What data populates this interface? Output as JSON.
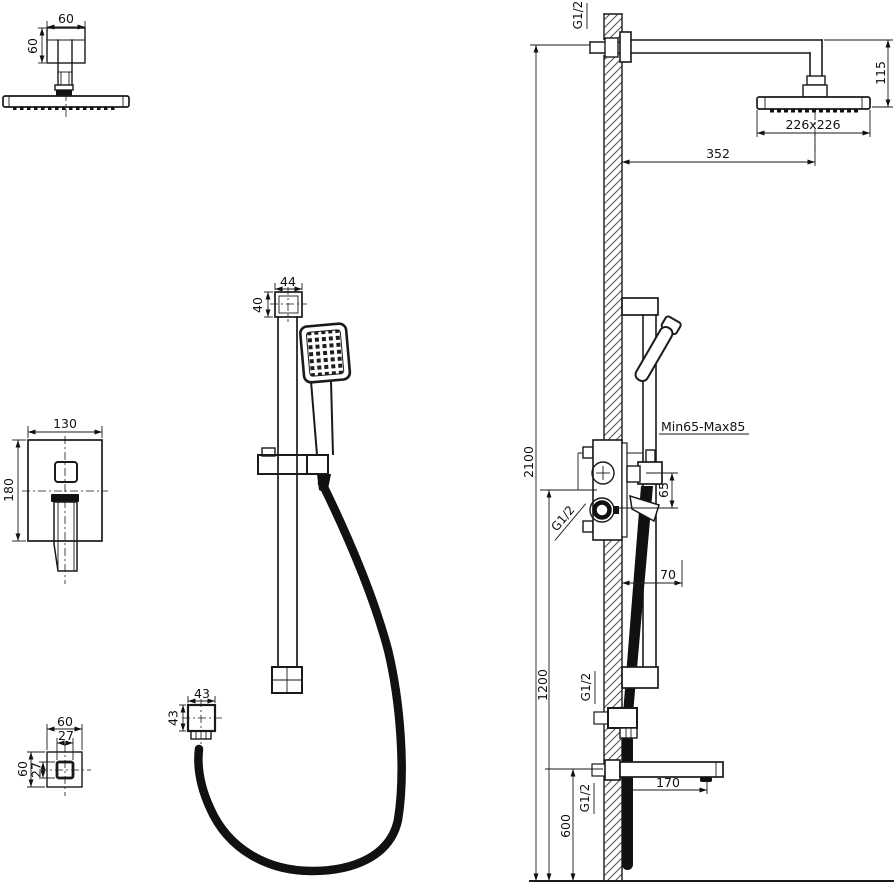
{
  "drawing": {
    "title": "shower-system-installation-drawing",
    "colors": {
      "line": "#1a1a1a",
      "background": "#ffffff",
      "hatch": "#555555"
    },
    "labels": {
      "overhead": {
        "width": "60",
        "height": "60"
      },
      "mixer": {
        "width": "130",
        "height": "180"
      },
      "wall_union": {
        "outer_width": "60",
        "inner_width": "27",
        "outer_height": "60",
        "inner_height": "27"
      },
      "hand_shower": {
        "cap_width": "44",
        "cap_height": "40",
        "union_width": "43",
        "union_height": "43"
      },
      "elevation": {
        "supply_thread": "G1/2",
        "head_drop": "115",
        "head_size": "226x226",
        "arm_reach": "352",
        "total_height": "2100",
        "valve_depth_range": "Min65-Max85",
        "port_spacing": "65",
        "valve_thread": "G1/2",
        "handle_projection": "70",
        "riser_height": "1200",
        "hose_outlet_thread": "G1/2",
        "spout_thread": "G1/2",
        "spout_reach": "170",
        "spout_height": "600"
      }
    }
  }
}
